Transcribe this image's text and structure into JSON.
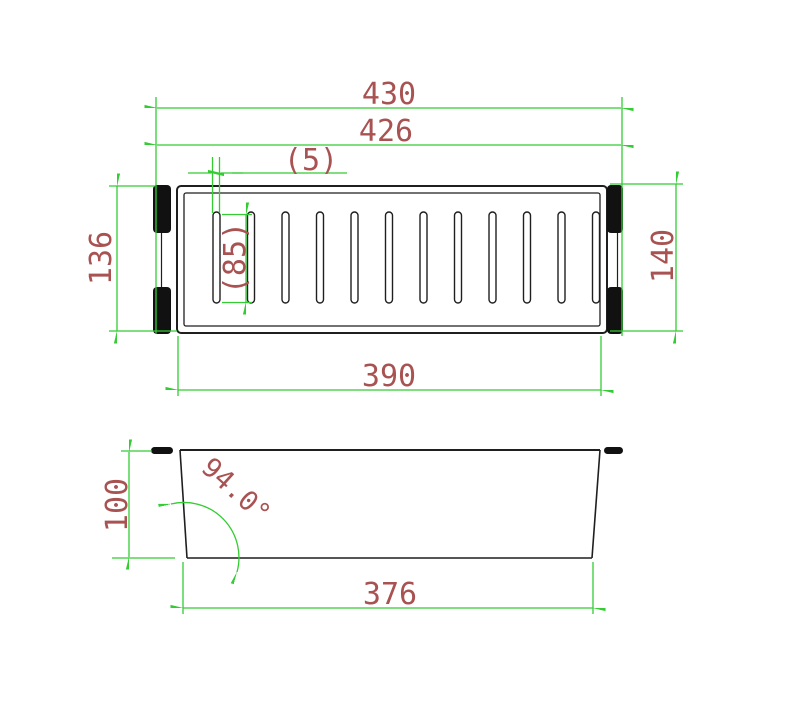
{
  "drawing": {
    "type": "engineering-dimension-drawing",
    "subject": "sink colander basket with slots and hanging handles",
    "views": {
      "top_view": {
        "slot_count": 12,
        "handle_bar_count": 4
      },
      "side_view": {
        "wall_count": 2,
        "tab_count": 2
      }
    }
  },
  "dimensions": {
    "top_view": {
      "overall_width": "430",
      "body_width": "426",
      "slot_width": "(5)",
      "slot_length": "(85)",
      "left_height": "136",
      "right_height": "140",
      "bottom_width": "390"
    },
    "side_view": {
      "height": "100",
      "wall_angle": "94.0°",
      "base_width": "376"
    }
  },
  "colors": {
    "dimension": "#33cc33",
    "text": "#a85252",
    "object": "#1f1f1f",
    "handle": "#111111",
    "background": "#ffffff"
  }
}
